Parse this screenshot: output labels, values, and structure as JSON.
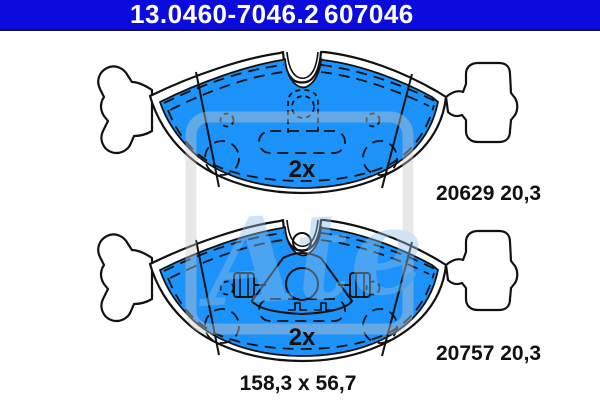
{
  "header": {
    "part_number": "13.0460-7046.2",
    "wva_number": "607046",
    "background_color": "#0b0bdd",
    "text_color": "#ffffff"
  },
  "drawing": {
    "pad_fill_color": "#1b93fb",
    "outline_color": "#111111",
    "pads": [
      {
        "position": "top",
        "label": "20629 20,3",
        "ref_number": "20629",
        "thickness_mm": "20,3",
        "quantity_label": "2x"
      },
      {
        "position": "bottom",
        "label": "20757 20,3",
        "ref_number": "20757",
        "thickness_mm": "20,3",
        "quantity_label": "2x"
      }
    ],
    "dimensions_label": "158,3 x 56,7",
    "width_mm": "158,3",
    "height_mm": "56,7"
  },
  "watermark": {
    "text": "Ate"
  }
}
